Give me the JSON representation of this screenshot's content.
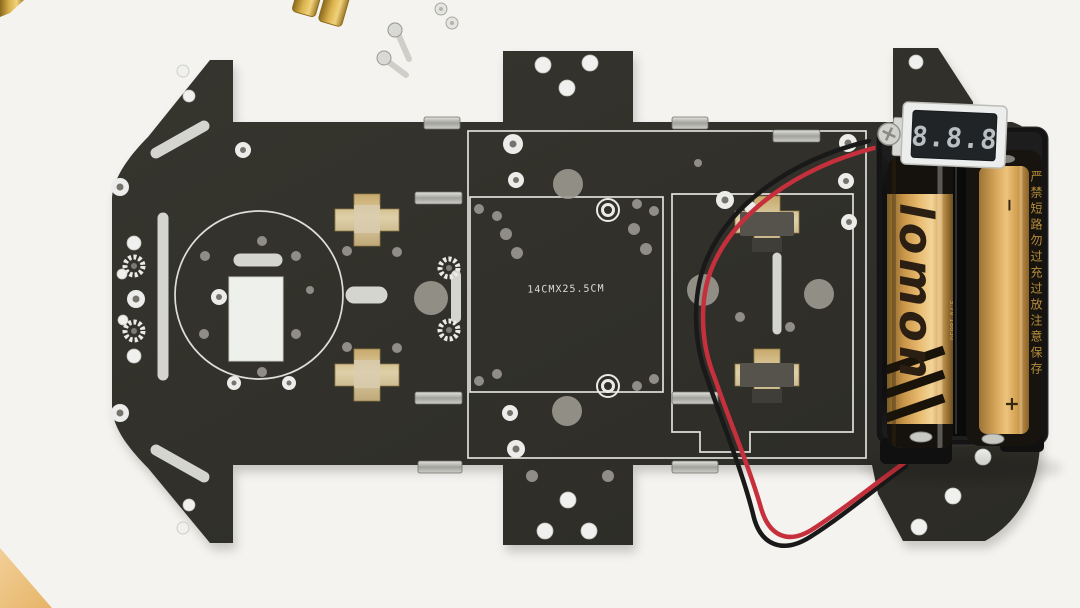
{
  "chassis": {
    "dimension_label": "14CMX25.5CM",
    "plate_color": "#31302a",
    "etch_color": "#e9e9e4"
  },
  "battery_pack": {
    "holder_color": "#141414",
    "left_cell": {
      "brand": "lomon",
      "spec_text": "3.7V 18650",
      "body_color": "#d9a85c",
      "brand_color": "#2a1f12"
    },
    "right_cell": {
      "warning_text": "严禁短路勿过充过放注意保存",
      "polarity_top": "−",
      "polarity_bottom": "+",
      "text_color": "#c99b3f"
    }
  },
  "voltmeter": {
    "digits": "8.8.8",
    "frame_color": "#eceded",
    "display_color": "#212427",
    "segment_color": "#c8cdd2"
  },
  "wiring": {
    "red": "#c5303c",
    "black": "#191919"
  },
  "hardware": {
    "brass_color": "#c8a23c",
    "screw_color": "#d8d8d4"
  },
  "backdrop": {
    "color": "#f4f3f0",
    "table_corner_color": "#eec98e"
  }
}
